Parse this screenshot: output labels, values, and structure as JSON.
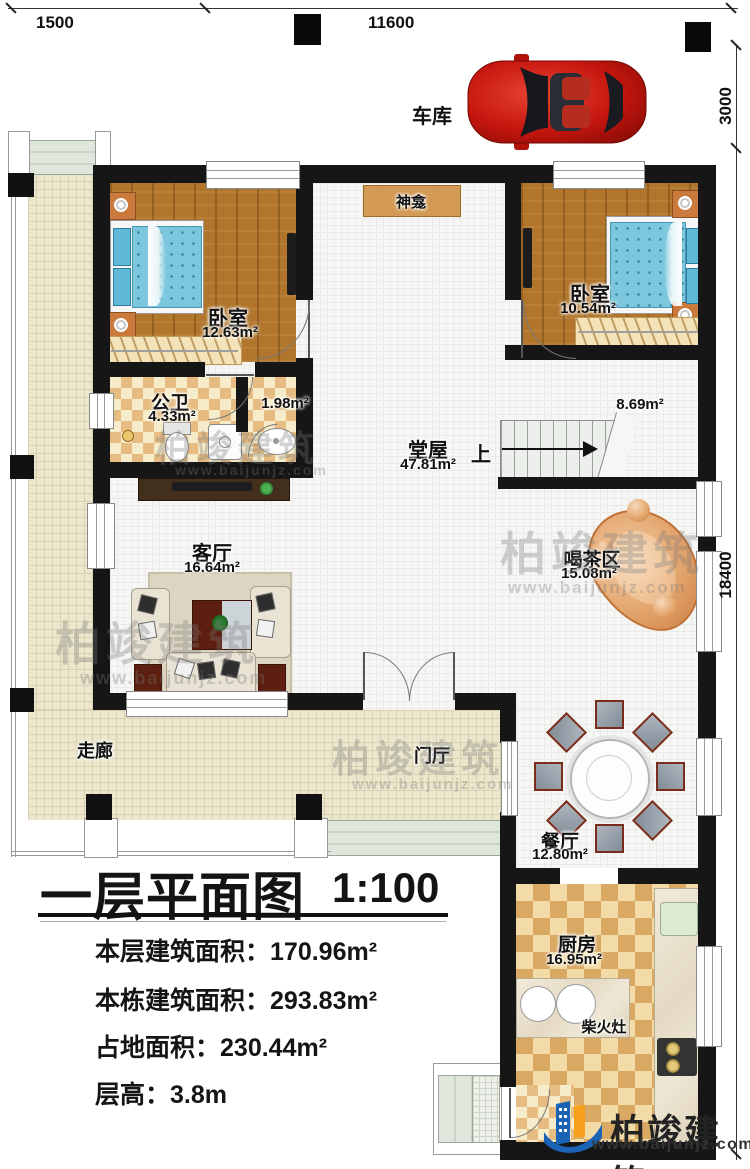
{
  "dimensions": {
    "top_left": "1500",
    "top_middle": "11600",
    "right_top": "3000",
    "right_side": "18400"
  },
  "garage": {
    "label": "车库"
  },
  "rooms": {
    "shrine": {
      "name": "神龛"
    },
    "bedroom_left": {
      "name": "卧室",
      "area": "12.63m²"
    },
    "bedroom_right": {
      "name": "卧室",
      "area": "10.54m²"
    },
    "bathroom": {
      "name": "公卫",
      "area": "4.33m²"
    },
    "bath_compartment": {
      "area": "1.98m²"
    },
    "hall": {
      "name": "堂屋",
      "area": "47.81m²"
    },
    "stair_landing": {
      "area": "8.69m²"
    },
    "stairs": {
      "up_label": "上"
    },
    "living_room": {
      "name": "客厅",
      "area": "16.64m²"
    },
    "tea_area": {
      "name": "喝茶区",
      "area": "15.08m²"
    },
    "corridor": {
      "name": "走廊"
    },
    "foyer": {
      "name": "门厅"
    },
    "dining_room": {
      "name": "餐厅",
      "area": "12.80m²"
    },
    "kitchen": {
      "name": "厨房",
      "area": "16.95m²"
    },
    "wood_stove": {
      "name": "柴火灶"
    }
  },
  "title_block": {
    "title": "一层平面图",
    "scale": "1:100",
    "stats": [
      {
        "label": "本层建筑面积：",
        "value": "170.96m²"
      },
      {
        "label": "本栋建筑面积：",
        "value": "293.83m²"
      },
      {
        "label": "占地面积：",
        "value": "230.44m²"
      },
      {
        "label": "层高：",
        "value": "3.8m"
      }
    ]
  },
  "branding": {
    "company": "柏竣建筑",
    "website": "www.baijunjz.com"
  },
  "watermark": {
    "text": "柏竣建筑",
    "url": "www.baijunjz.com"
  },
  "colors": {
    "wall": "#161616",
    "wood_floor": "#b1762c",
    "tile_floor": "#f6f6f4",
    "corridor_floor": "#ebe6cc",
    "bath_check_dark": "#e6bc82",
    "kitchen_check_dark": "#d9a964",
    "bed_blue": "#7cc7de",
    "tea_table_orange": "#dd9257",
    "car_red": "#c4160e",
    "brand_blue": "#1b63b5",
    "brand_orange": "#f59f1c"
  }
}
